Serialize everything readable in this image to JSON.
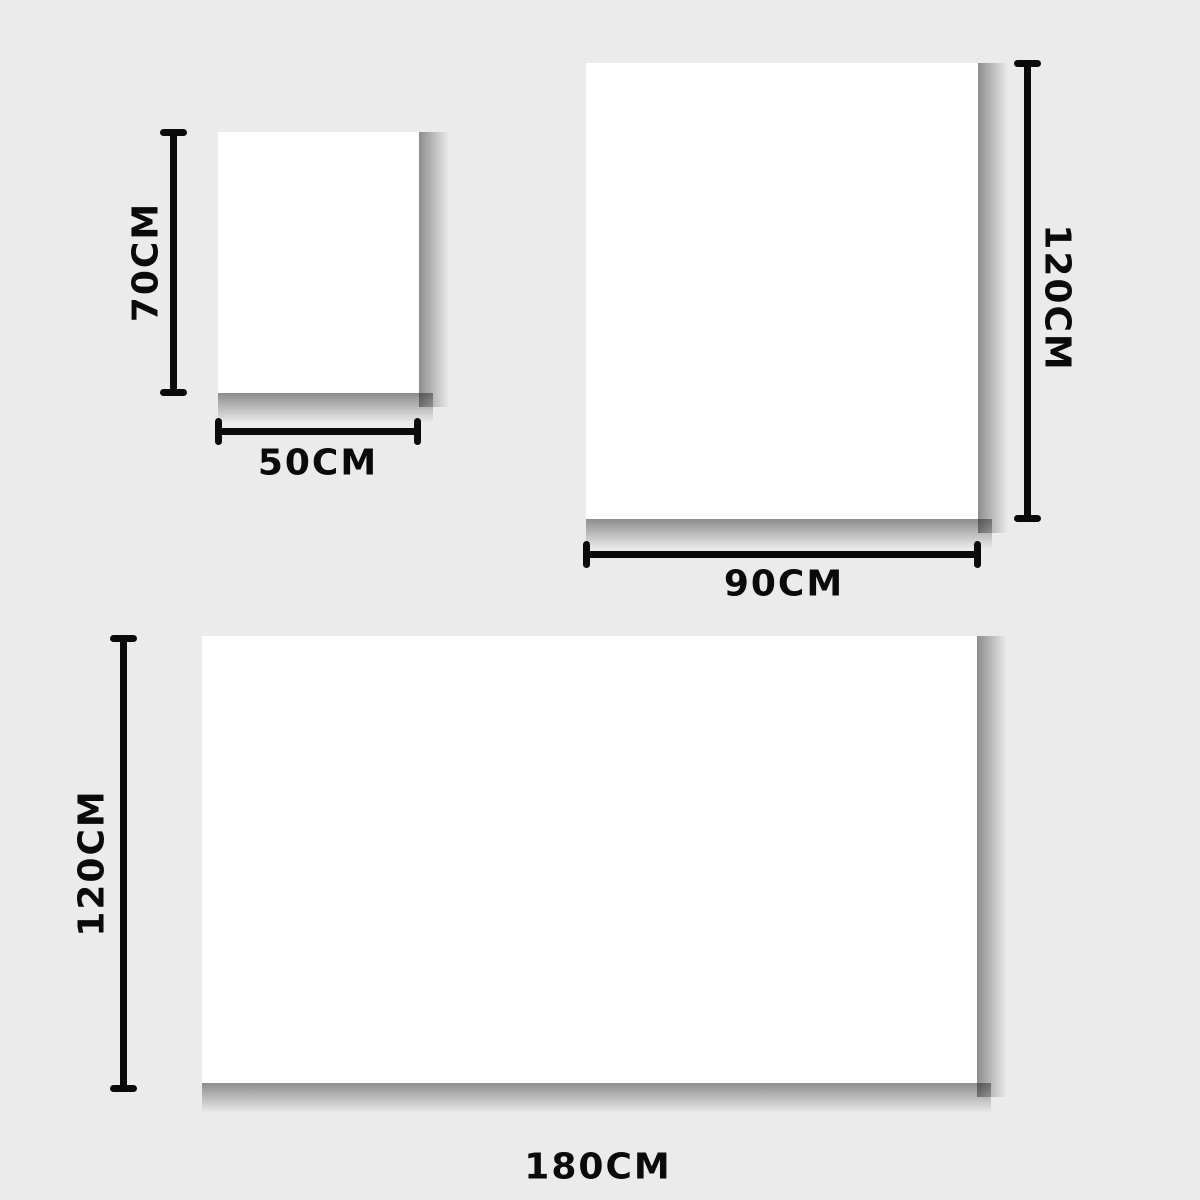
{
  "colors": {
    "background": "#ebebeb",
    "ink": "#0a0a0a",
    "surface": "#ffffff"
  },
  "panels": {
    "small": {
      "width_label": "50CM",
      "height_label": "70CM"
    },
    "medium": {
      "width_label": "90CM",
      "height_label": "120CM"
    },
    "large": {
      "width_label": "180CM",
      "height_label": "120CM"
    }
  }
}
